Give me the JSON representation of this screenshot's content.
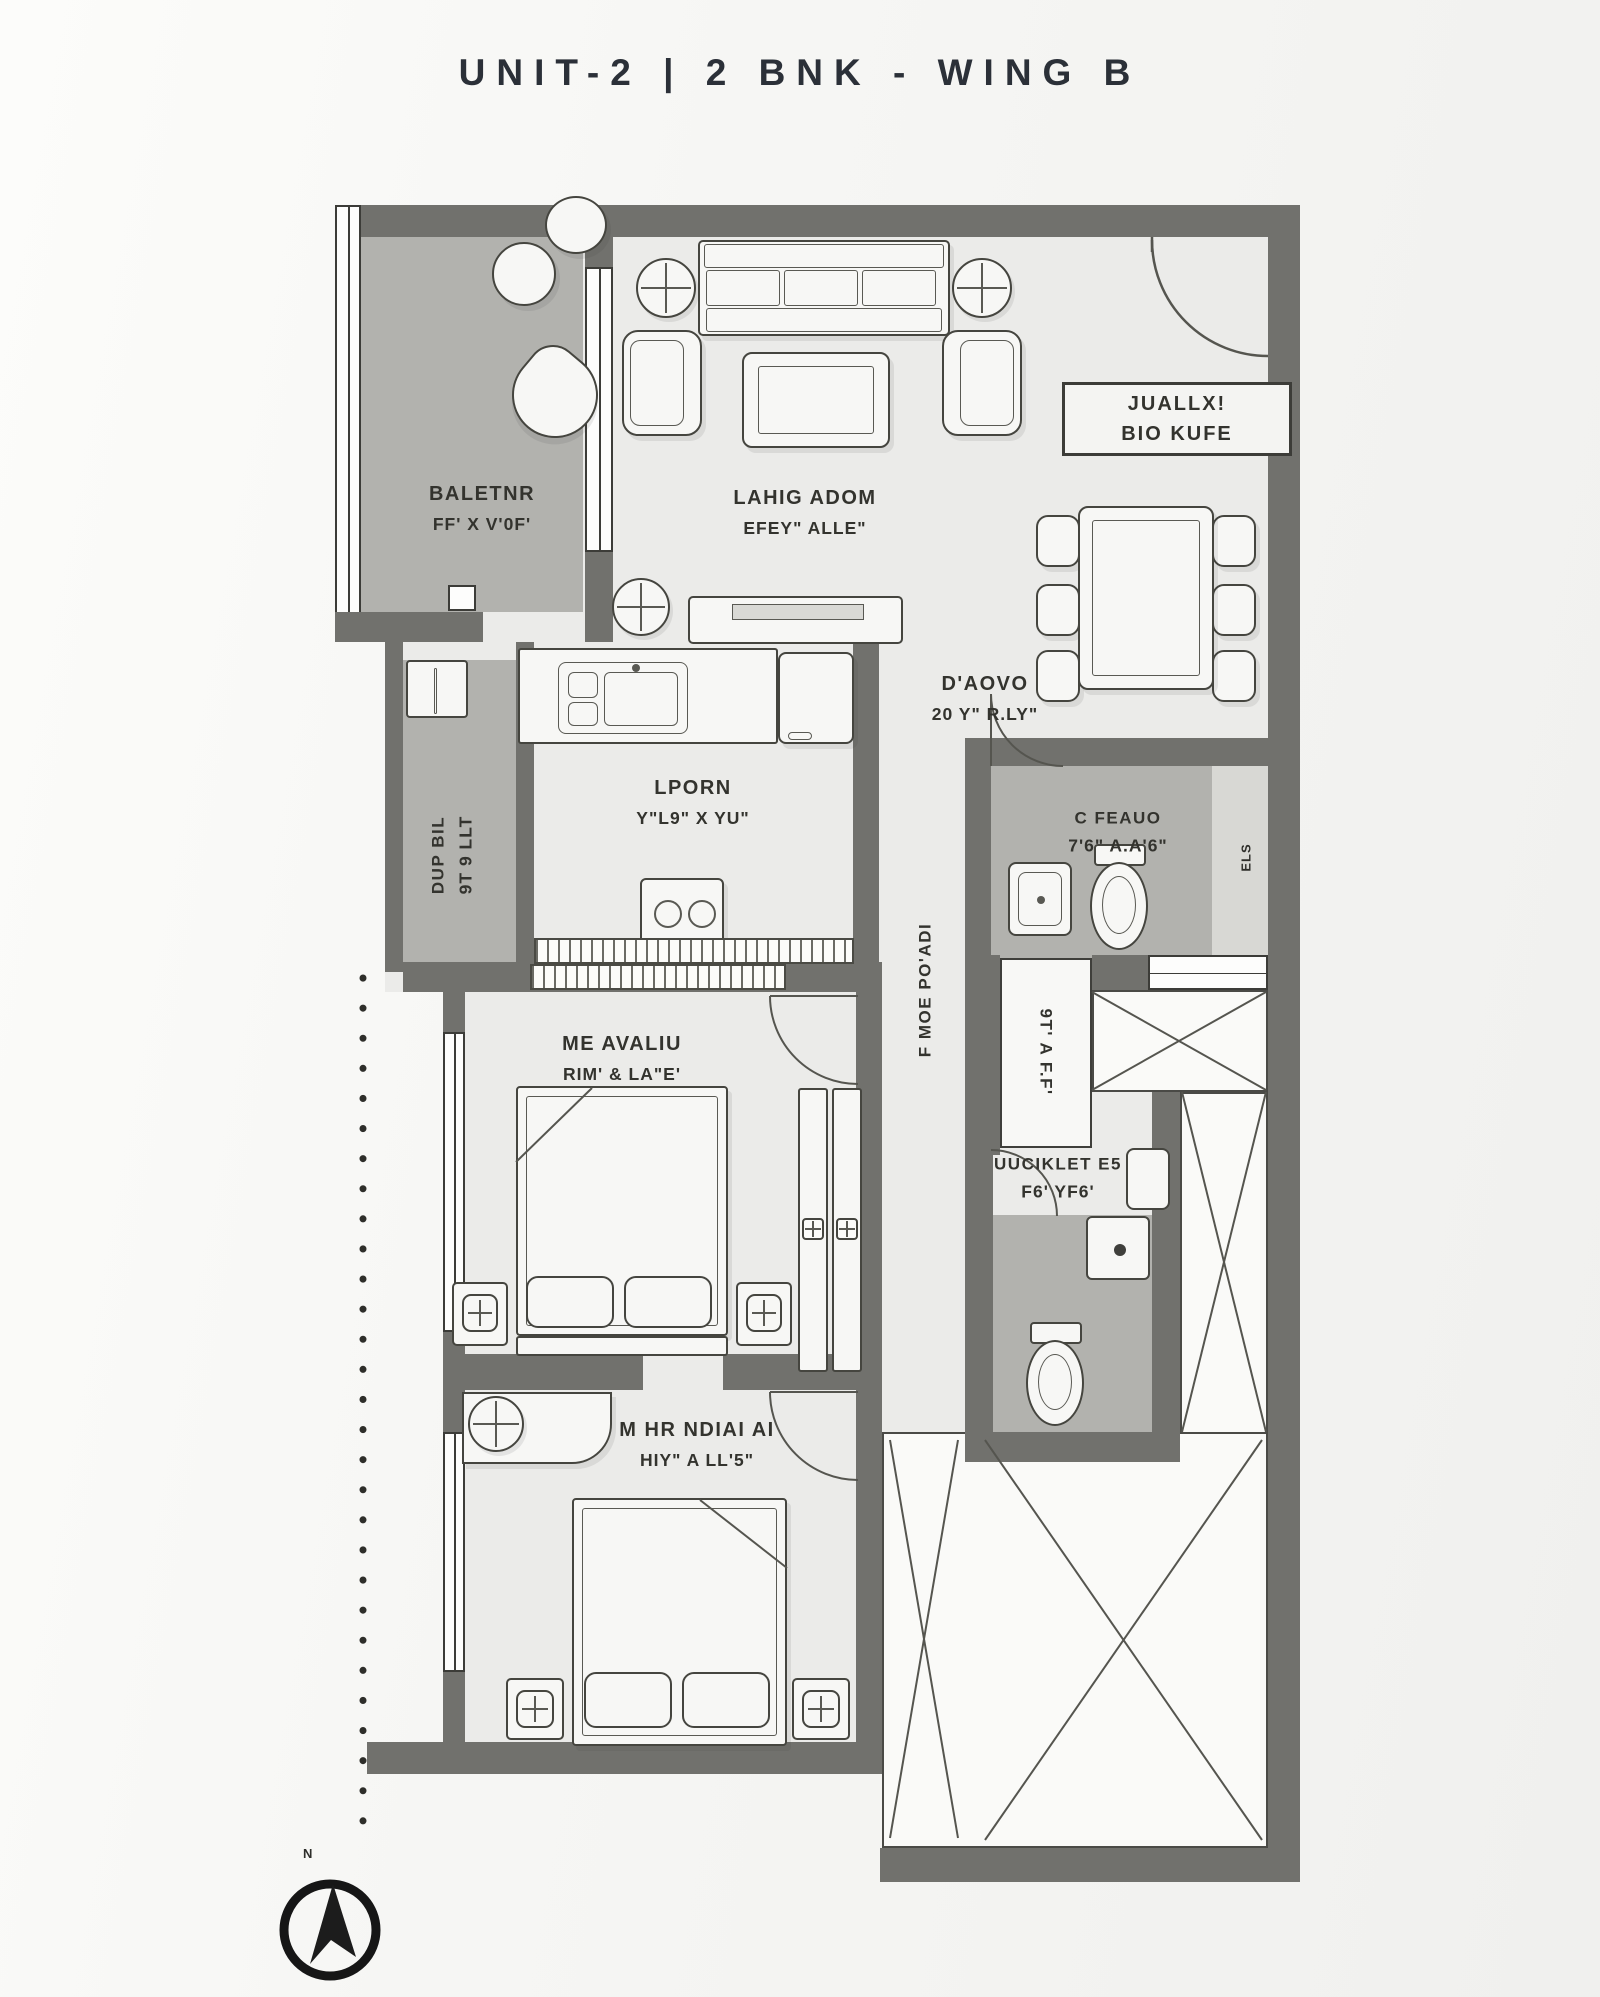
{
  "title": "UNIT-2 | 2 BNK - WING B",
  "colors": {
    "wall": "#71716d",
    "floor": "#ebebe9",
    "dark_floor": "#b2b2ae",
    "outline": "#45453f",
    "paper": "#f6f6f4",
    "title_text": "#2b3038"
  },
  "rooms": {
    "balcony": {
      "name": "BALETNR",
      "dim": "FF' X V'0F'"
    },
    "living": {
      "name": "LAHIG ADOM",
      "dim": "EFEY\" ALLE\""
    },
    "dining": {
      "name": "D'AOVO",
      "dim": "20 Y\" R.LY\""
    },
    "foyer": {
      "name": "JUALLX!",
      "dim": "BIO KUFE"
    },
    "kitchen": {
      "name": "LPORN",
      "dim": "Y\"L9\" X YU\""
    },
    "dry_balcony": {
      "name": "DUP BIL",
      "dim": "9T 9 LLT"
    },
    "toilet1": {
      "name": "C FEAUO",
      "dim": "7'6\" A.A'6\""
    },
    "passage": {
      "name": "F MOE PO'ADI",
      "dim": ""
    },
    "niche": {
      "name": "9T' A F.F'",
      "dim": ""
    },
    "bedroom1": {
      "name": "ME AVALIU",
      "dim": "RIM' & LA\"E'"
    },
    "toilet2": {
      "name": "UUCIKLET E5",
      "dim": "F6' YF6'"
    },
    "bedroom2": {
      "name": "M HR NDIAI AI",
      "dim": "HIY\" A LL'5\""
    }
  },
  "annotations": {
    "vent": "ELS",
    "compass_north": "N"
  }
}
